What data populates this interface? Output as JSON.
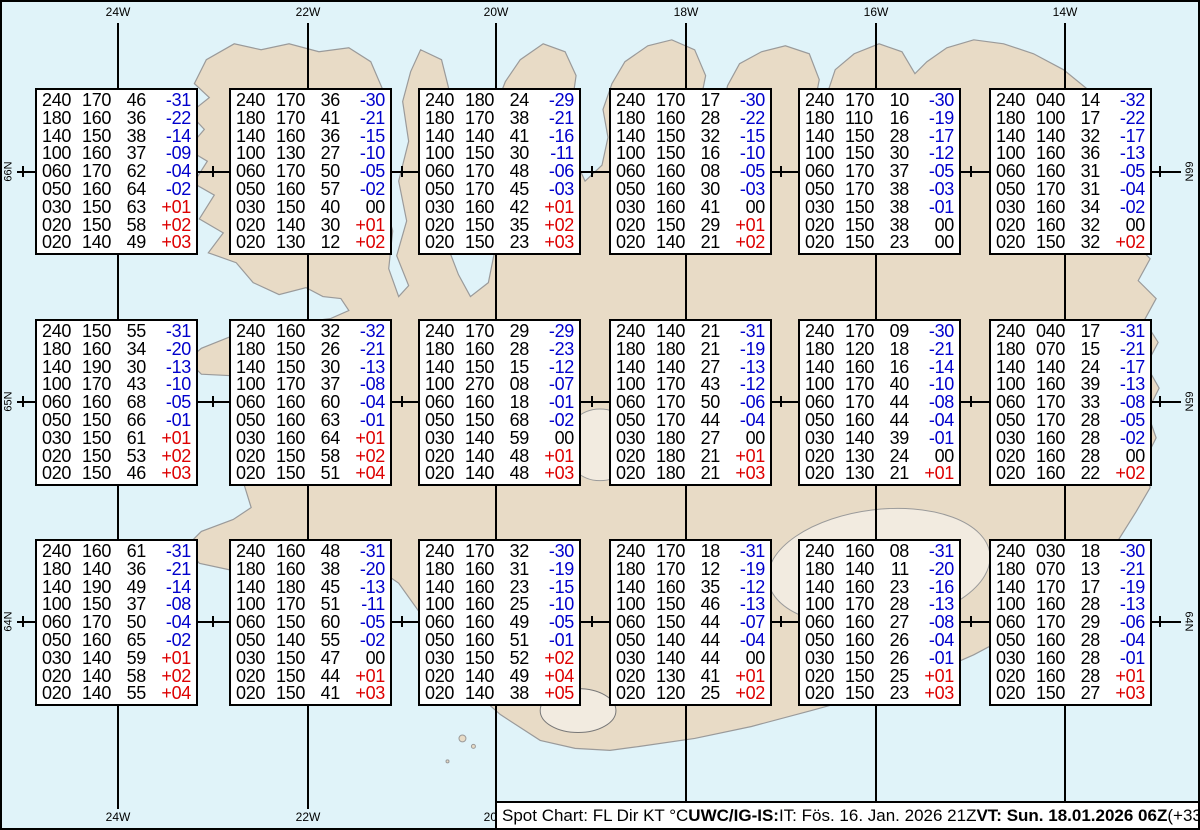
{
  "colors": {
    "sea": "#e0f3f9",
    "land": "#e8dbc6",
    "coast": "#9a9a9a",
    "grid": "#000000",
    "temp_negative": "#0000cc",
    "temp_positive": "#dd0000",
    "temp_zero": "#000000"
  },
  "grid": {
    "verticals": [
      {
        "x": 116,
        "label": "24W"
      },
      {
        "x": 306,
        "label": "22W"
      },
      {
        "x": 494,
        "label": "20W"
      },
      {
        "x": 684,
        "label": "18W"
      },
      {
        "x": 874,
        "label": "16W"
      },
      {
        "x": 1063,
        "label": "14W"
      }
    ],
    "horizontals": [
      {
        "y": 170,
        "label": "66N"
      },
      {
        "y": 400,
        "label": "65N"
      },
      {
        "y": 620,
        "label": "64N"
      }
    ],
    "minor_tick_xs": [
      21,
      211,
      400,
      590,
      779,
      969,
      1158
    ]
  },
  "spot_boxes": [
    {
      "x": 33,
      "y": 86,
      "rows": [
        [
          "240",
          "170",
          "46",
          "-31"
        ],
        [
          "180",
          "160",
          "36",
          "-22"
        ],
        [
          "140",
          "150",
          "38",
          "-14"
        ],
        [
          "100",
          "160",
          "37",
          "-09"
        ],
        [
          "060",
          "170",
          "62",
          "-04"
        ],
        [
          "050",
          "160",
          "64",
          "-02"
        ],
        [
          "030",
          "150",
          "63",
          "+01"
        ],
        [
          "020",
          "150",
          "58",
          "+02"
        ],
        [
          "020",
          "140",
          "49",
          "+03"
        ]
      ]
    },
    {
      "x": 227,
      "y": 86,
      "rows": [
        [
          "240",
          "170",
          "36",
          "-30"
        ],
        [
          "180",
          "170",
          "41",
          "-21"
        ],
        [
          "140",
          "160",
          "36",
          "-15"
        ],
        [
          "100",
          "130",
          "27",
          "-10"
        ],
        [
          "060",
          "170",
          "50",
          "-05"
        ],
        [
          "050",
          "160",
          "57",
          "-02"
        ],
        [
          "030",
          "150",
          "40",
          "00"
        ],
        [
          "020",
          "140",
          "30",
          "+01"
        ],
        [
          "020",
          "130",
          "12",
          "+02"
        ]
      ]
    },
    {
      "x": 416,
      "y": 86,
      "rows": [
        [
          "240",
          "180",
          "24",
          "-29"
        ],
        [
          "180",
          "170",
          "38",
          "-21"
        ],
        [
          "140",
          "140",
          "41",
          "-16"
        ],
        [
          "100",
          "150",
          "30",
          "-11"
        ],
        [
          "060",
          "170",
          "48",
          "-06"
        ],
        [
          "050",
          "170",
          "45",
          "-03"
        ],
        [
          "030",
          "160",
          "42",
          "+01"
        ],
        [
          "020",
          "150",
          "35",
          "+02"
        ],
        [
          "020",
          "150",
          "23",
          "+03"
        ]
      ]
    },
    {
      "x": 607,
      "y": 86,
      "rows": [
        [
          "240",
          "170",
          "17",
          "-30"
        ],
        [
          "180",
          "160",
          "28",
          "-22"
        ],
        [
          "140",
          "150",
          "32",
          "-15"
        ],
        [
          "100",
          "150",
          "16",
          "-10"
        ],
        [
          "060",
          "160",
          "08",
          "-05"
        ],
        [
          "050",
          "160",
          "30",
          "-03"
        ],
        [
          "030",
          "160",
          "41",
          "00"
        ],
        [
          "020",
          "150",
          "29",
          "+01"
        ],
        [
          "020",
          "140",
          "21",
          "+02"
        ]
      ]
    },
    {
      "x": 796,
      "y": 86,
      "rows": [
        [
          "240",
          "170",
          "10",
          "-30"
        ],
        [
          "180",
          "110",
          "16",
          "-19"
        ],
        [
          "140",
          "150",
          "28",
          "-17"
        ],
        [
          "100",
          "150",
          "30",
          "-12"
        ],
        [
          "060",
          "170",
          "37",
          "-05"
        ],
        [
          "050",
          "170",
          "38",
          "-03"
        ],
        [
          "030",
          "150",
          "38",
          "-01"
        ],
        [
          "020",
          "150",
          "38",
          "00"
        ],
        [
          "020",
          "150",
          "23",
          "00"
        ]
      ]
    },
    {
      "x": 987,
      "y": 86,
      "rows": [
        [
          "240",
          "040",
          "14",
          "-32"
        ],
        [
          "180",
          "100",
          "17",
          "-22"
        ],
        [
          "140",
          "140",
          "32",
          "-17"
        ],
        [
          "100",
          "160",
          "36",
          "-13"
        ],
        [
          "060",
          "160",
          "31",
          "-05"
        ],
        [
          "050",
          "170",
          "31",
          "-04"
        ],
        [
          "030",
          "160",
          "34",
          "-02"
        ],
        [
          "020",
          "160",
          "32",
          "00"
        ],
        [
          "020",
          "150",
          "32",
          "+02"
        ]
      ]
    },
    {
      "x": 33,
      "y": 317,
      "rows": [
        [
          "240",
          "150",
          "55",
          "-31"
        ],
        [
          "180",
          "160",
          "34",
          "-20"
        ],
        [
          "140",
          "190",
          "30",
          "-13"
        ],
        [
          "100",
          "170",
          "43",
          "-10"
        ],
        [
          "060",
          "160",
          "68",
          "-05"
        ],
        [
          "050",
          "150",
          "66",
          "-01"
        ],
        [
          "030",
          "150",
          "61",
          "+01"
        ],
        [
          "020",
          "150",
          "53",
          "+02"
        ],
        [
          "020",
          "150",
          "46",
          "+03"
        ]
      ]
    },
    {
      "x": 227,
      "y": 317,
      "rows": [
        [
          "240",
          "160",
          "32",
          "-32"
        ],
        [
          "180",
          "150",
          "26",
          "-21"
        ],
        [
          "140",
          "150",
          "30",
          "-13"
        ],
        [
          "100",
          "170",
          "37",
          "-08"
        ],
        [
          "060",
          "160",
          "60",
          "-04"
        ],
        [
          "050",
          "160",
          "63",
          "-01"
        ],
        [
          "030",
          "160",
          "64",
          "+01"
        ],
        [
          "020",
          "150",
          "58",
          "+02"
        ],
        [
          "020",
          "150",
          "51",
          "+04"
        ]
      ]
    },
    {
      "x": 416,
      "y": 317,
      "rows": [
        [
          "240",
          "170",
          "29",
          "-29"
        ],
        [
          "180",
          "160",
          "28",
          "-23"
        ],
        [
          "140",
          "150",
          "15",
          "-12"
        ],
        [
          "100",
          "270",
          "08",
          "-07"
        ],
        [
          "060",
          "160",
          "18",
          "-01"
        ],
        [
          "050",
          "150",
          "68",
          "-02"
        ],
        [
          "030",
          "140",
          "59",
          "00"
        ],
        [
          "020",
          "140",
          "48",
          "+01"
        ],
        [
          "020",
          "140",
          "48",
          "+03"
        ]
      ]
    },
    {
      "x": 607,
      "y": 317,
      "rows": [
        [
          "240",
          "140",
          "21",
          "-31"
        ],
        [
          "180",
          "180",
          "21",
          "-19"
        ],
        [
          "140",
          "140",
          "27",
          "-13"
        ],
        [
          "100",
          "170",
          "43",
          "-12"
        ],
        [
          "060",
          "170",
          "50",
          "-06"
        ],
        [
          "050",
          "170",
          "44",
          "-04"
        ],
        [
          "030",
          "180",
          "27",
          "00"
        ],
        [
          "020",
          "180",
          "21",
          "+01"
        ],
        [
          "020",
          "180",
          "21",
          "+03"
        ]
      ]
    },
    {
      "x": 796,
      "y": 317,
      "rows": [
        [
          "240",
          "170",
          "09",
          "-30"
        ],
        [
          "180",
          "120",
          "18",
          "-21"
        ],
        [
          "140",
          "160",
          "16",
          "-14"
        ],
        [
          "100",
          "170",
          "40",
          "-10"
        ],
        [
          "060",
          "170",
          "44",
          "-08"
        ],
        [
          "050",
          "160",
          "44",
          "-04"
        ],
        [
          "030",
          "140",
          "39",
          "-01"
        ],
        [
          "020",
          "130",
          "24",
          "00"
        ],
        [
          "020",
          "130",
          "21",
          "+01"
        ]
      ]
    },
    {
      "x": 987,
      "y": 317,
      "rows": [
        [
          "240",
          "040",
          "17",
          "-31"
        ],
        [
          "180",
          "070",
          "15",
          "-21"
        ],
        [
          "140",
          "140",
          "24",
          "-17"
        ],
        [
          "100",
          "160",
          "39",
          "-13"
        ],
        [
          "060",
          "170",
          "33",
          "-08"
        ],
        [
          "050",
          "170",
          "28",
          "-05"
        ],
        [
          "030",
          "160",
          "28",
          "-02"
        ],
        [
          "020",
          "160",
          "28",
          "00"
        ],
        [
          "020",
          "160",
          "22",
          "+02"
        ]
      ]
    },
    {
      "x": 33,
      "y": 537,
      "rows": [
        [
          "240",
          "160",
          "61",
          "-31"
        ],
        [
          "180",
          "140",
          "36",
          "-21"
        ],
        [
          "140",
          "190",
          "49",
          "-14"
        ],
        [
          "100",
          "150",
          "37",
          "-08"
        ],
        [
          "060",
          "170",
          "50",
          "-04"
        ],
        [
          "050",
          "160",
          "65",
          "-02"
        ],
        [
          "030",
          "140",
          "59",
          "+01"
        ],
        [
          "020",
          "140",
          "58",
          "+02"
        ],
        [
          "020",
          "140",
          "55",
          "+04"
        ]
      ]
    },
    {
      "x": 227,
      "y": 537,
      "rows": [
        [
          "240",
          "160",
          "48",
          "-31"
        ],
        [
          "180",
          "160",
          "38",
          "-20"
        ],
        [
          "140",
          "180",
          "45",
          "-13"
        ],
        [
          "100",
          "170",
          "51",
          "-11"
        ],
        [
          "060",
          "150",
          "60",
          "-05"
        ],
        [
          "050",
          "140",
          "55",
          "-02"
        ],
        [
          "030",
          "150",
          "47",
          "00"
        ],
        [
          "020",
          "150",
          "44",
          "+01"
        ],
        [
          "020",
          "150",
          "41",
          "+03"
        ]
      ]
    },
    {
      "x": 416,
      "y": 537,
      "rows": [
        [
          "240",
          "170",
          "32",
          "-30"
        ],
        [
          "180",
          "160",
          "31",
          "-19"
        ],
        [
          "140",
          "160",
          "23",
          "-15"
        ],
        [
          "100",
          "160",
          "25",
          "-10"
        ],
        [
          "060",
          "160",
          "49",
          "-05"
        ],
        [
          "050",
          "160",
          "51",
          "-01"
        ],
        [
          "030",
          "150",
          "52",
          "+02"
        ],
        [
          "020",
          "140",
          "49",
          "+04"
        ],
        [
          "020",
          "140",
          "38",
          "+05"
        ]
      ]
    },
    {
      "x": 607,
      "y": 537,
      "rows": [
        [
          "240",
          "170",
          "18",
          "-31"
        ],
        [
          "180",
          "170",
          "12",
          "-19"
        ],
        [
          "140",
          "160",
          "35",
          "-12"
        ],
        [
          "100",
          "150",
          "46",
          "-13"
        ],
        [
          "060",
          "150",
          "44",
          "-07"
        ],
        [
          "050",
          "140",
          "44",
          "-04"
        ],
        [
          "030",
          "140",
          "44",
          "00"
        ],
        [
          "020",
          "130",
          "41",
          "+01"
        ],
        [
          "020",
          "120",
          "25",
          "+02"
        ]
      ]
    },
    {
      "x": 796,
      "y": 537,
      "rows": [
        [
          "240",
          "160",
          "08",
          "-31"
        ],
        [
          "180",
          "140",
          "11",
          "-20"
        ],
        [
          "140",
          "160",
          "23",
          "-16"
        ],
        [
          "100",
          "170",
          "28",
          "-13"
        ],
        [
          "060",
          "160",
          "27",
          "-08"
        ],
        [
          "050",
          "160",
          "26",
          "-04"
        ],
        [
          "030",
          "150",
          "26",
          "-01"
        ],
        [
          "020",
          "150",
          "25",
          "+01"
        ],
        [
          "020",
          "150",
          "23",
          "+03"
        ]
      ]
    },
    {
      "x": 987,
      "y": 537,
      "rows": [
        [
          "240",
          "030",
          "18",
          "-30"
        ],
        [
          "180",
          "070",
          "13",
          "-21"
        ],
        [
          "140",
          "170",
          "17",
          "-19"
        ],
        [
          "100",
          "160",
          "28",
          "-13"
        ],
        [
          "060",
          "170",
          "29",
          "-06"
        ],
        [
          "050",
          "160",
          "28",
          "-04"
        ],
        [
          "030",
          "160",
          "28",
          "-01"
        ],
        [
          "020",
          "160",
          "28",
          "+01"
        ],
        [
          "020",
          "150",
          "27",
          "+03"
        ]
      ]
    }
  ],
  "footer": {
    "segments": [
      {
        "text": "Spot Chart: FL Dir KT °C ",
        "bold": false
      },
      {
        "text": "UWC/IG-IS:",
        "bold": true
      },
      {
        "text": " IT: Fös. 16. Jan. 2026 21Z ",
        "bold": false
      },
      {
        "text": "VT: Sun. 18.01.2026 06Z",
        "bold": true
      },
      {
        "text": " (+33 h)",
        "bold": false
      }
    ]
  }
}
